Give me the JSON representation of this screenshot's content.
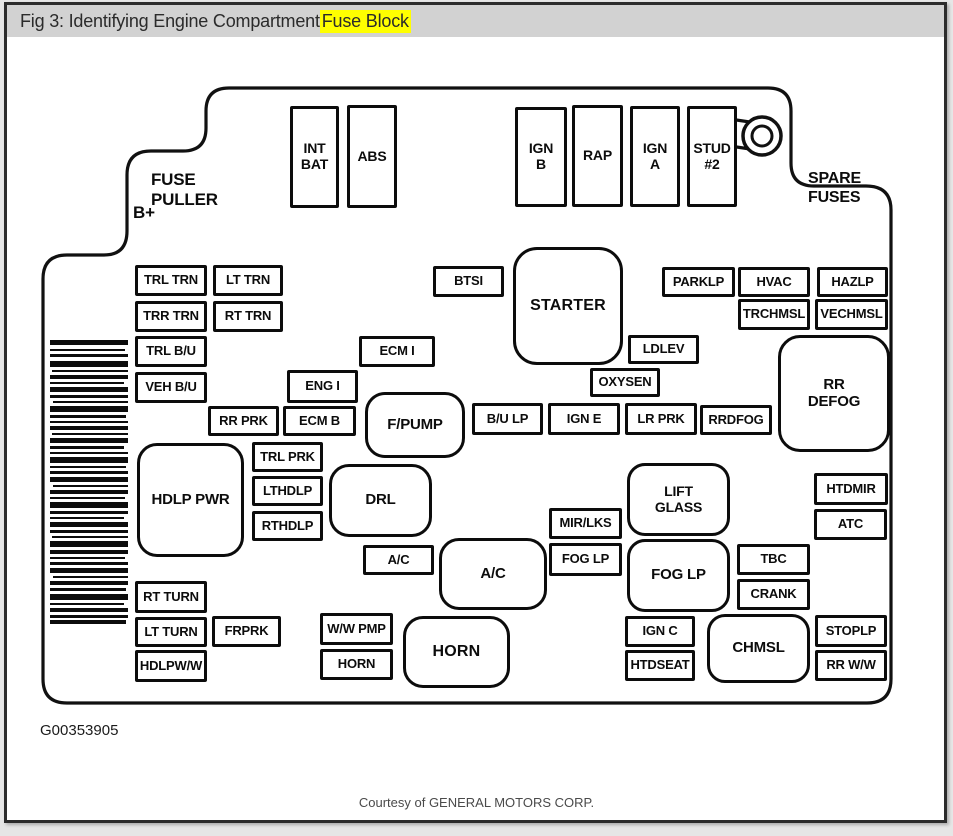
{
  "header": {
    "title_prefix": "Fig 3: Identifying Engine Compartment ",
    "title_highlight": "Fuse Block"
  },
  "diagram": {
    "annotations": {
      "fuse_puller": "FUSE\nPULLER",
      "b_plus": "B+",
      "spare_fuses": "SPARE\nFUSES"
    },
    "fuses": {
      "int_bat": "INT\nBAT",
      "abs": "ABS",
      "ign_b": "IGN\nB",
      "rap": "RAP",
      "ign_a": "IGN\nA",
      "stud2": "STUD\n#2",
      "trl_trn": "TRL TRN",
      "lt_trn": "LT TRN",
      "trr_trn": "TRR TRN",
      "rt_trn": "RT TRN",
      "trl_bu": "TRL B/U",
      "veh_bu": "VEH B/U",
      "btsi": "BTSI",
      "starter": "STARTER",
      "parklp": "PARKLP",
      "hvac": "HVAC",
      "hazlp": "HAZLP",
      "trchmsl": "TRCHMSL",
      "vechmsl": "VECHMSL",
      "ecm_i": "ECM I",
      "eng_i": "ENG I",
      "ldlev": "LDLEV",
      "oxysen": "OXYSEN",
      "rr_defog": "RR\nDEFOG",
      "rr_prk": "RR PRK",
      "ecm_b": "ECM B",
      "fpump": "F/PUMP",
      "bu_lp": "B/U LP",
      "ign_e": "IGN E",
      "lr_prk": "LR PRK",
      "rrdfog": "RRDFOG",
      "hdlp_pwr": "HDLP PWR",
      "trl_prk": "TRL PRK",
      "lthdlp": "LTHDLP",
      "rthdlp": "RTHDLP",
      "drl": "DRL",
      "ac_small": "A/C",
      "ac_big": "A/C",
      "mir_lks": "MIR/LKS",
      "fog_lp_small": "FOG LP",
      "lift_glass": "LIFT\nGLASS",
      "fog_lp_big": "FOG LP",
      "htdmir": "HTDMIR",
      "atc": "ATC",
      "tbc": "TBC",
      "crank": "CRANK",
      "rt_turn": "RT TURN",
      "lt_turn": "LT TURN",
      "frprk": "FRPRK",
      "hdlpww": "HDLPW/W",
      "ww_pmp": "W/W PMP",
      "horn_small": "HORN",
      "horn_big": "HORN",
      "ign_c": "IGN C",
      "htdseat": "HTDSEAT",
      "chmsl": "CHMSL",
      "stoplp": "STOPLP",
      "rr_ww": "RR W/W"
    }
  },
  "footer": {
    "figure_id": "G00353905",
    "credit": "Courtesy of GENERAL MOTORS CORP."
  }
}
